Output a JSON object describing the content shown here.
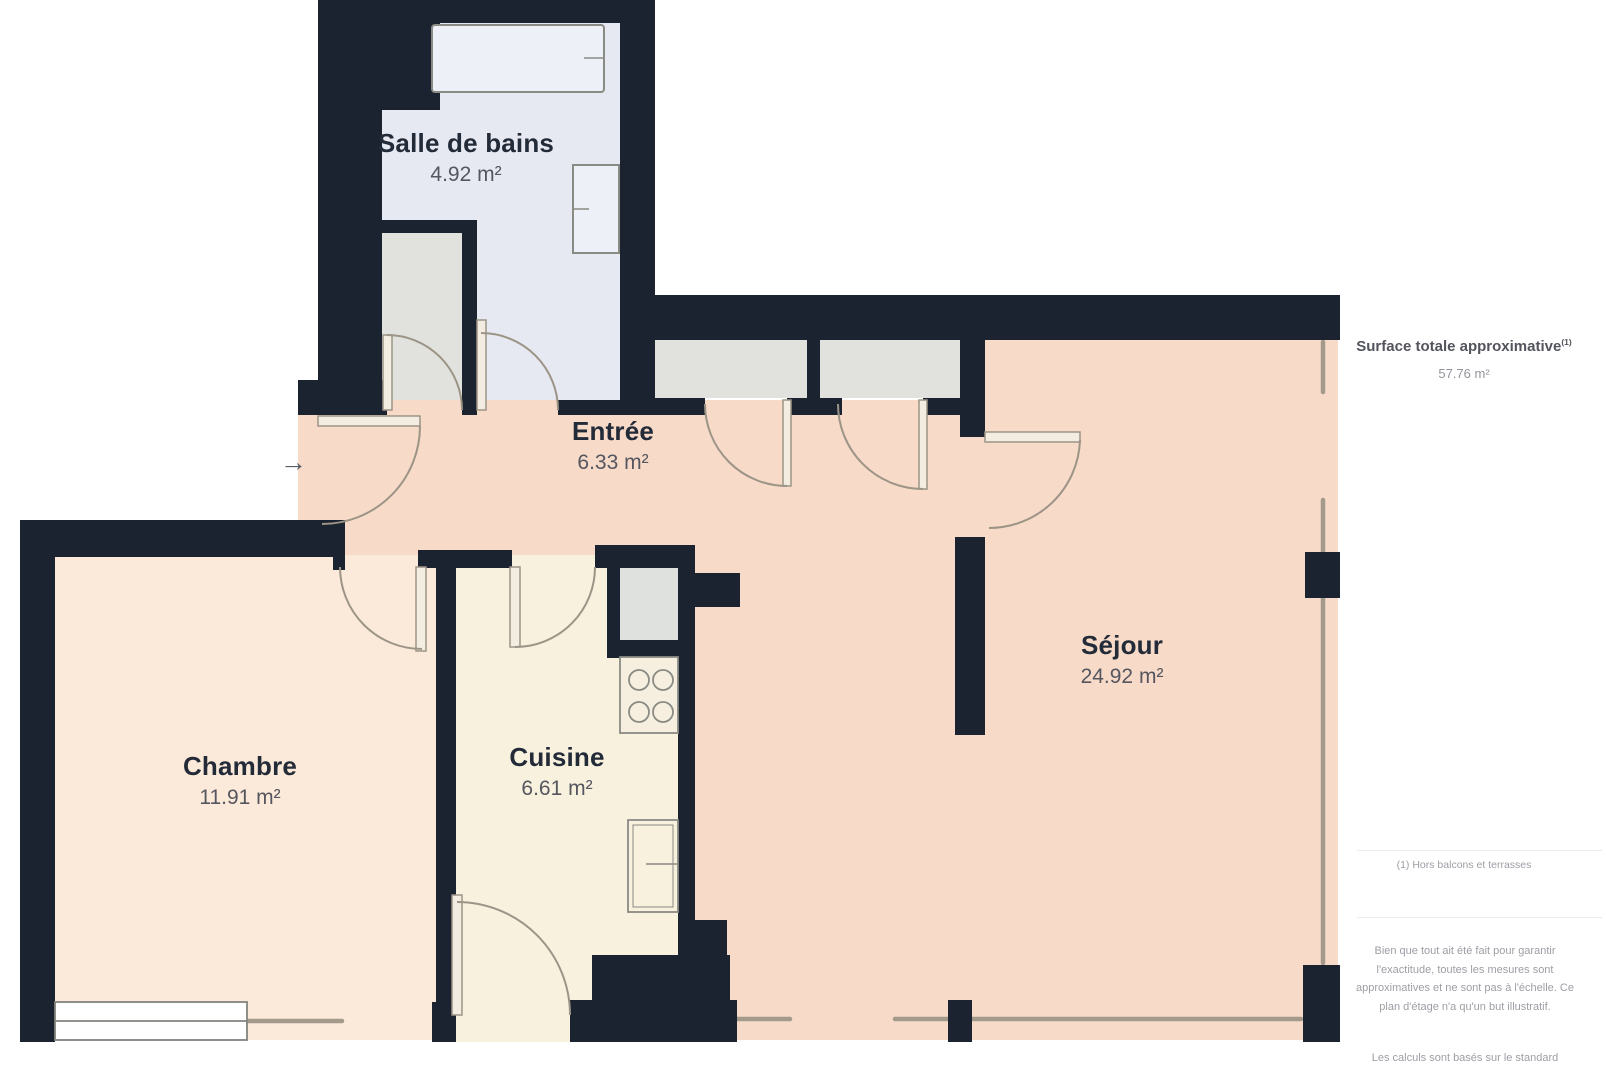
{
  "plan": {
    "rooms": [
      {
        "id": "salle-de-bains",
        "label": "Salle de bains",
        "area": "4.92 m²"
      },
      {
        "id": "entree",
        "label": "Entrée",
        "area": "6.33 m²"
      },
      {
        "id": "chambre",
        "label": "Chambre",
        "area": "11.91 m²"
      },
      {
        "id": "cuisine",
        "label": "Cuisine",
        "area": "6.61 m²"
      },
      {
        "id": "sejour",
        "label": "Séjour",
        "area": "24.92 m²"
      }
    ],
    "entrance_arrow": "→",
    "colors": {
      "wall": "#1b2330",
      "bathroom": "#e6e9f1",
      "hall_living": "#f7dac7",
      "bedroom": "#fbe9d9",
      "kitchen": "#f8f1de",
      "closet": "#e1e2dd",
      "door_stroke": "#9c9486",
      "window_stroke": "#a39a8b"
    }
  },
  "sidebar": {
    "surface_title": "Surface totale approximative",
    "surface_title_superscript": "(1)",
    "surface_total": "57.76 m²",
    "footnote": "(1) Hors balcons et terrasses",
    "disclaimer": "Bien que tout ait été fait pour garantir l'exactitude, toutes les mesures sont approximatives et ne sont pas à l'échelle. Ce plan d'étage n'a qu'un but illustratif.",
    "standard_note": "Les calculs sont basés sur le standard"
  }
}
